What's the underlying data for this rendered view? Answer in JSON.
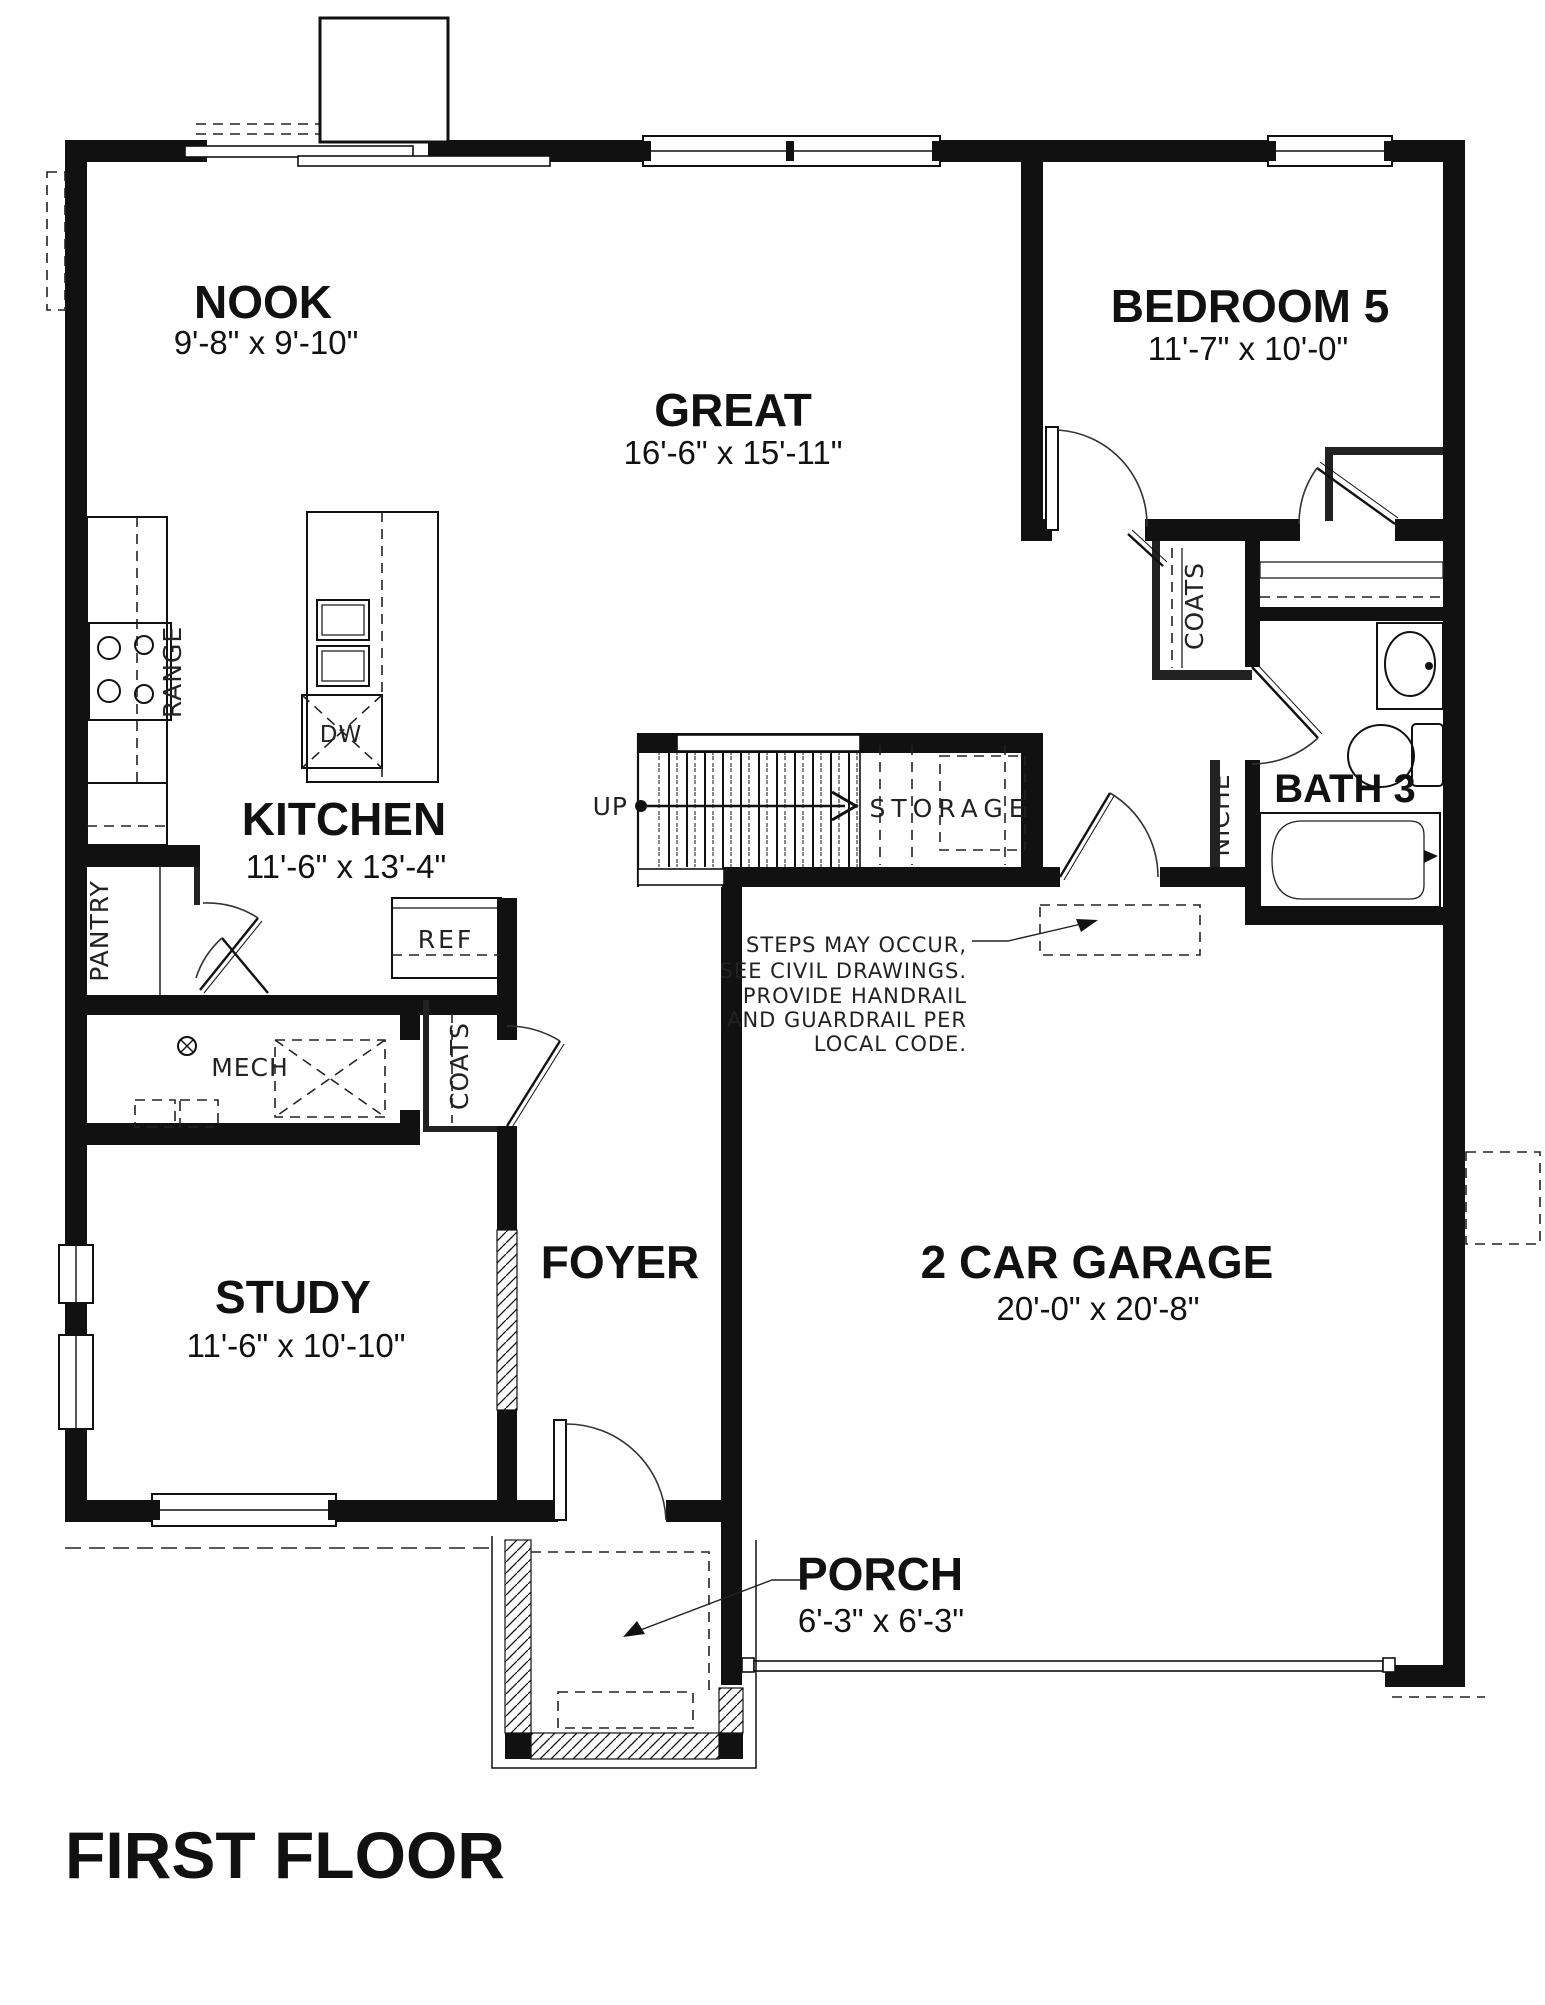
{
  "title": "FIRST FLOOR",
  "rooms": {
    "nook": {
      "label": "NOOK",
      "dims": "9'-8\" x 9'-10\""
    },
    "great": {
      "label": "GREAT",
      "dims": "16'-6\" x 15'-11\""
    },
    "bedroom5": {
      "label": "BEDROOM 5",
      "dims": "11'-7\" x 10'-0\""
    },
    "kitchen": {
      "label": "KITCHEN",
      "dims": "11'-6\" x 13'-4\""
    },
    "bath3": {
      "label": "BATH 3"
    },
    "study": {
      "label": "STUDY",
      "dims": "11'-6\" x 10'-10\""
    },
    "foyer": {
      "label": "FOYER"
    },
    "garage": {
      "label": "2 CAR GARAGE",
      "dims": "20'-0\" x 20'-8\""
    },
    "porch": {
      "label": "PORCH",
      "dims": "6'-3\" x 6'-3\""
    }
  },
  "features": {
    "up": "UP",
    "storage": "STORAGE",
    "mech": "MECH",
    "ref": "REF",
    "dw": "DW",
    "range": "RANGE",
    "pantry": "PANTRY",
    "coats_foyer": "COATS",
    "coats_hall": "COATS",
    "niche": "NICHE"
  },
  "note_lines": [
    "STEPS MAY OCCUR,",
    "SEE CIVIL DRAWINGS.",
    "PROVIDE HANDRAIL",
    "AND GUARDRAIL PER",
    "LOCAL CODE."
  ],
  "colors": {
    "ink": "#111111",
    "paper": "#ffffff"
  }
}
